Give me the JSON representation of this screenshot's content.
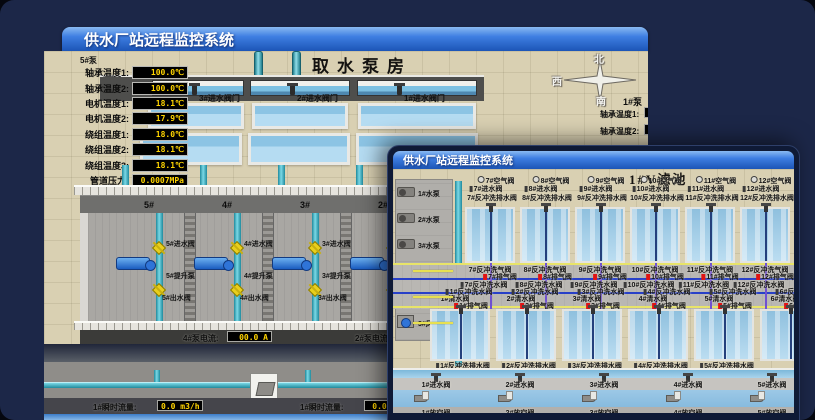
{
  "back_window": {
    "title": "供水厂站远程监控系统",
    "scene_title": "取水泵房",
    "inlet_valves": [
      "3#进水阀门",
      "2#进水阀门",
      "1#进水阀门"
    ],
    "pump_panel": {
      "header": "5#泵",
      "rows": [
        {
          "label": "轴承温度1:",
          "value": "100.0℃"
        },
        {
          "label": "轴承温度2:",
          "value": "100.0℃"
        },
        {
          "label": "电机温度1:",
          "value": "18.1℃"
        },
        {
          "label": "电机温度2:",
          "value": "17.9℃"
        },
        {
          "label": "绕组温度1:",
          "value": "18.0℃"
        },
        {
          "label": "绕组温度2:",
          "value": "18.1℃"
        },
        {
          "label": "绕组温度3:",
          "value": "18.1℃"
        },
        {
          "label": "管道压力:",
          "value": "0.0007MPa"
        },
        {
          "label": "多功能阀:",
          "value": "0%"
        }
      ]
    },
    "compass": {
      "north": "北",
      "west": "西",
      "south": "南"
    },
    "right_panel": {
      "header": "1#泵",
      "labels": [
        "轴承温度1:",
        "轴承温度2:"
      ]
    },
    "pump_bays": [
      {
        "no": "5#",
        "inlet": "5#进水阀",
        "pump": "5#提升泵",
        "outlet": "5#出水阀"
      },
      {
        "no": "4#",
        "inlet": "4#进水阀",
        "pump": "4#提升泵",
        "outlet": "4#出水阀"
      },
      {
        "no": "3#",
        "inlet": "3#进水阀",
        "pump": "3#提升泵",
        "outlet": "3#出水阀"
      },
      {
        "no": "2#",
        "inlet": "2#进水阀",
        "pump": "2#提升泵",
        "outlet": "2#出水阀"
      }
    ],
    "current_readings": [
      {
        "label": "4#泵电流:",
        "value": "00.0 A"
      },
      {
        "label": "2#泵电流:",
        "value": ""
      }
    ],
    "flow_readings": [
      {
        "label": "1#瞬时流量:",
        "value": "0.0 m3/h"
      },
      {
        "label": "1#瞬时流量:",
        "value": "0.0 m3/"
      }
    ]
  },
  "front_window": {
    "title": "供水厂站远程监控系统",
    "scene_title": "1#V滤池",
    "equipment": [
      "1#水泵",
      "2#水泵",
      "3#水泵",
      "1#风机",
      "2#风机",
      "3#风机"
    ],
    "top_rows": {
      "air": [
        "7#空气阀",
        "8#空气阀",
        "9#空气阀",
        "10#空气阀",
        "11#空气阀",
        "12#空气阀"
      ],
      "inlet": [
        "7#进水阀",
        "8#进水阀",
        "9#进水阀",
        "10#进水阀",
        "11#进水阀",
        "12#进水阀"
      ],
      "drain": [
        "7#反冲洗排水阀",
        "8#反冲洗排水阀",
        "9#反冲洗排水阀",
        "10#反冲洗排水阀",
        "11#反冲洗排水阀",
        "12#反冲洗排水阀"
      ]
    },
    "corridor_rows": [
      {
        "name": "upper-air-scour-valves",
        "icon": "none",
        "labels": [
          "7#反冲洗气阀",
          "8#反冲洗气阀",
          "9#反冲洗气阀",
          "10#反冲洗气阀",
          "11#反冲洗气阀",
          "12#反冲洗气阀"
        ]
      },
      {
        "name": "upper-exhaust-valves",
        "icon": "red",
        "labels": [
          "7#排气阀",
          "8#排气阀",
          "9#排气阀",
          "10#排气阀",
          "11#排气阀",
          "12#排气阀"
        ]
      },
      {
        "name": "upper-backwash-water-valves",
        "icon": "post",
        "labels": [
          "7#反冲洗水阀",
          "8#反冲洗水阀",
          "9#反冲洗水阀",
          "10#反冲洗水阀",
          "11#反冲洗水阀",
          "12#反冲洗水阀"
        ]
      },
      {
        "name": "lower-backwash-water-valves",
        "icon": "post",
        "labels": [
          "1#反冲洗水阀",
          "2#反冲洗水阀",
          "3#反冲洗水阀",
          "4#反冲洗水阀",
          "5#反冲洗水阀",
          "6#反冲洗水阀"
        ]
      },
      {
        "name": "lower-clean-water-valves",
        "icon": "none",
        "labels": [
          "1#清水阀",
          "2#清水阀",
          "3#清水阀",
          "4#清水阀",
          "5#清水阀",
          "6#清水阀"
        ]
      },
      {
        "name": "lower-exhaust-valves",
        "icon": "red",
        "labels": [
          "1#排气阀",
          "2#排气阀",
          "3#排气阀",
          "4#排气阀",
          "5#排气阀",
          "6#排气阀"
        ]
      }
    ],
    "bottom_rows": {
      "drain": [
        "1#反冲洗排水阀",
        "2#反冲洗排水阀",
        "3#反冲洗排水阀",
        "4#反冲洗排水阀",
        "5#反冲洗排水阀"
      ],
      "inlet": [
        "1#进水阀",
        "2#进水阀",
        "3#进水阀",
        "4#进水阀",
        "5#进水阀"
      ],
      "empty": [
        "1#放空阀",
        "2#放空阀",
        "3#放空阀",
        "4#放空阀",
        "5#放空阀"
      ]
    }
  },
  "colors": {
    "titlebar_blue": "#2f6fd6",
    "desktop_navy": "#1c2748",
    "ground_tan": "#d9d0b2",
    "value_yellow": "#ffd400",
    "pipe_teal": "#3fb8c8",
    "valve_yellow": "#e9cf1c",
    "alarm_red": "#e01414",
    "water_blue": "#a6cfe8"
  }
}
